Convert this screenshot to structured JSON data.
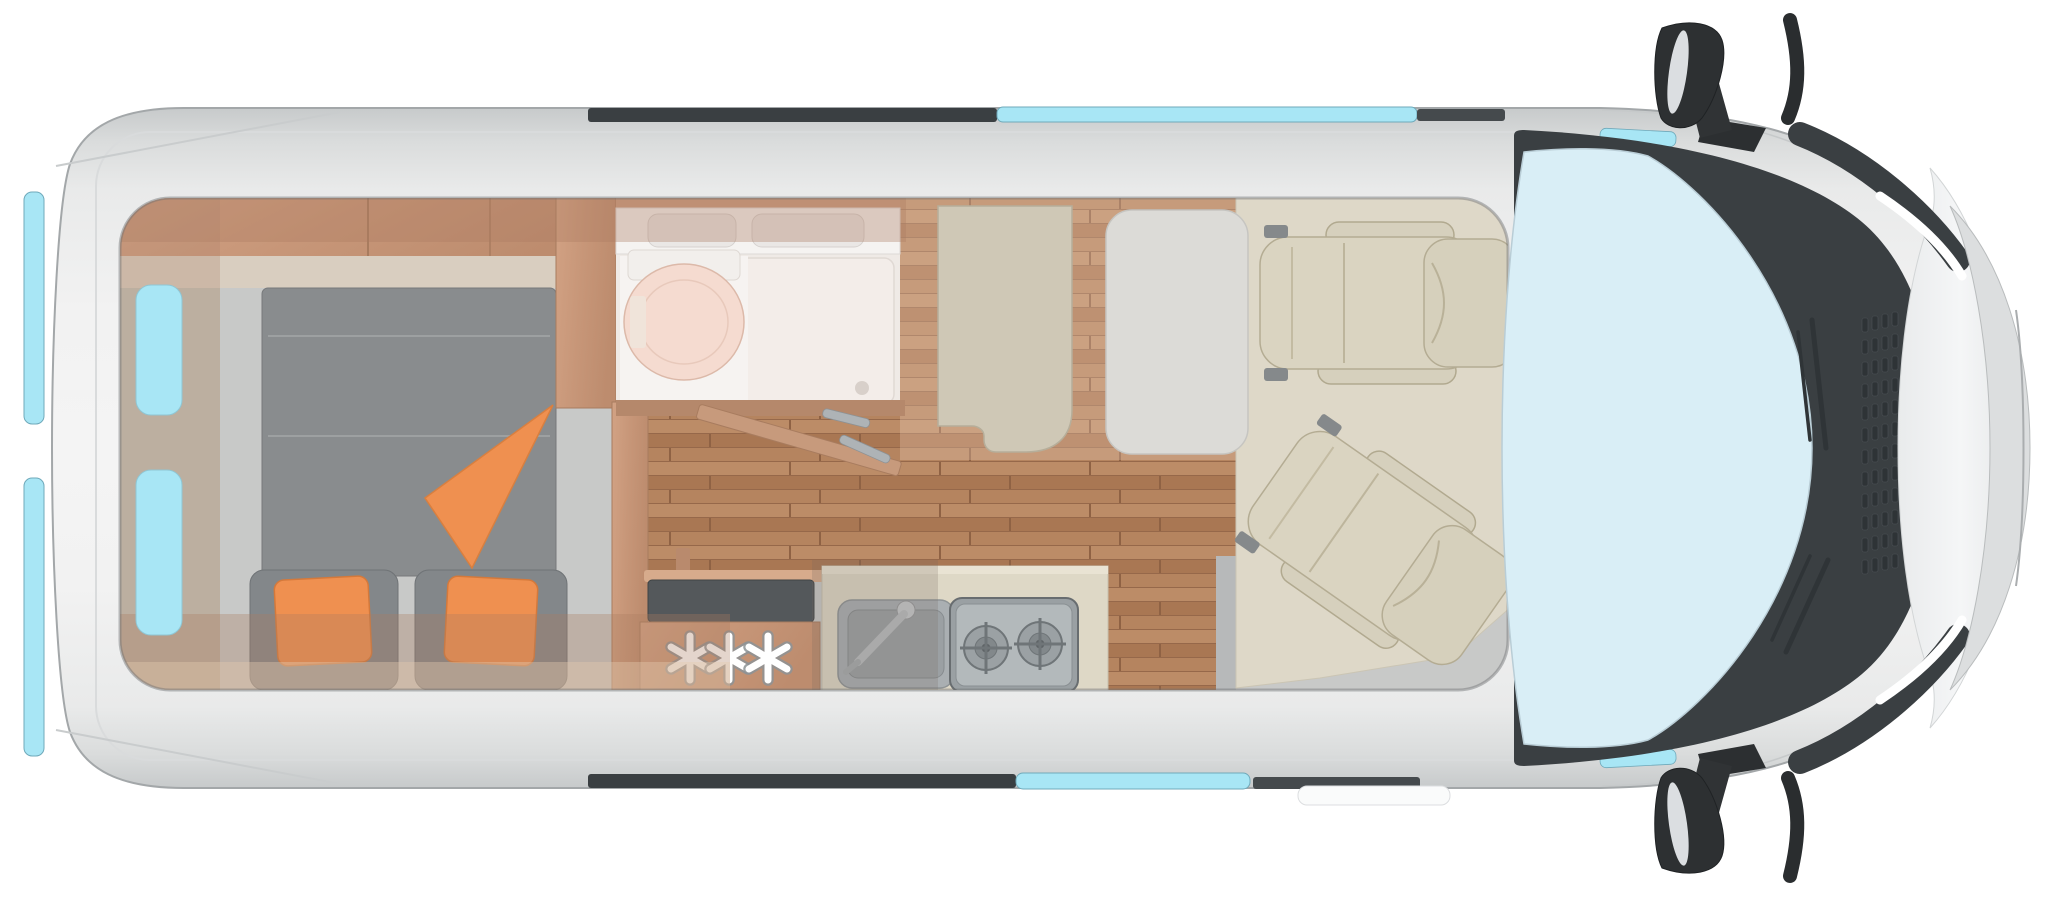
{
  "floorplan": {
    "fridge_marker": "✳✳✳",
    "vehicle": "campervan-top-view-cutaway",
    "parts": [
      "van-body",
      "rear-doors",
      "rear-door-windows",
      "rear-bed",
      "bed-cushions",
      "orange-pillows",
      "orange-blanket",
      "overhead-lockers",
      "wardrobe-wall",
      "bathroom",
      "vanity-with-basins",
      "toilet",
      "shower-tray",
      "bathroom-door",
      "corridor-wood-floor",
      "fridge-freezer",
      "kitchen-counter",
      "kitchen-sink",
      "gas-hob",
      "dinette-bench",
      "dinette-table",
      "cab-floor-mat",
      "swivel-seat-rear-facing",
      "swivel-seat-rotated",
      "windshield",
      "wipers",
      "cowl-vents",
      "hood",
      "front-bumper",
      "headlights",
      "side-mirror-top",
      "side-mirror-bottom",
      "sliding-door-window",
      "entry-step"
    ],
    "colors": {
      "page_bg": "#ffffff",
      "body": "#f2f2f2",
      "body_edge": "#c7cacb",
      "outline": "#a3a7a9",
      "window_glass": "#a8e6f5",
      "windshield": "#d9eef6",
      "dark_trim": "#3a3f42",
      "mirror": "#2d3032",
      "hood": "#f3f4f5",
      "bumper": "#dcdedf",
      "wood_cabinet": "#c89a7c",
      "wood_wall": "#b5886b",
      "wood_floor": "#b2805d",
      "mattress": "#898c8e",
      "bed_base": "#c8c9c8",
      "cushion": "#83878a",
      "accent_orange": "#ef9050",
      "bathroom_floor": "#efeae6",
      "shower_tray": "#f3ede9",
      "toilet": "#f5dbd0",
      "vanity": "#f5f3f1",
      "counter": "#ded8c6",
      "sink_steel": "#aaafb2",
      "hob": "#b3b9bb",
      "fridge_top": "#54585b",
      "bench": "#cfc8b6",
      "seat": "#dad4c1",
      "seat_outline": "#b4ac93",
      "table": "#dcdbd7",
      "cab_mat": "#ded8c8",
      "step": "#fafbfb",
      "star": "#ffffff"
    }
  }
}
